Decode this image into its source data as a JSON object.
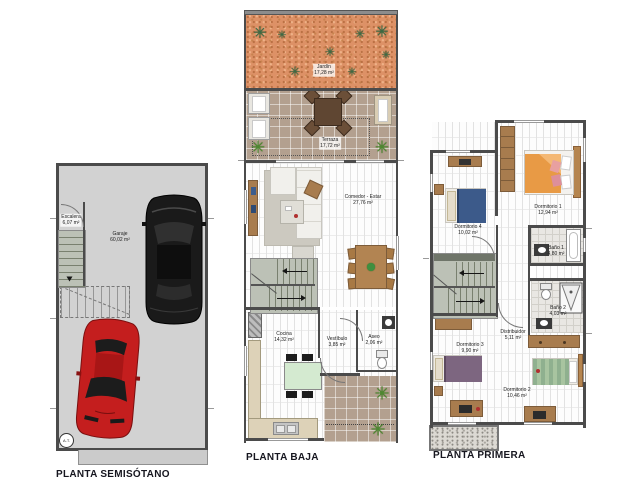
{
  "plans": {
    "semisotano": {
      "title": "PLANTA SEMISÓTANO",
      "at_label": "A.T.",
      "rooms": {
        "escalera": {
          "name": "Escalera",
          "area": "6,07 m²"
        },
        "garaje": {
          "name": "Garaje",
          "area": "60,02 m²"
        }
      }
    },
    "baja": {
      "title": "PLANTA BAJA",
      "rooms": {
        "jardin": {
          "name": "Jardín",
          "area": "17,28 m²"
        },
        "terraza": {
          "name": "Terraza",
          "area": "17,72 m²"
        },
        "comedor": {
          "name": "Comedor - Estar",
          "area": "27,76 m²"
        },
        "cocina": {
          "name": "Cocina",
          "area": "14,32 m²"
        },
        "vestibulo": {
          "name": "Vestíbulo",
          "area": "3,85 m²"
        },
        "aseo": {
          "name": "Aseo",
          "area": "2,06 m²"
        }
      }
    },
    "primera": {
      "title": "PLANTA PRIMERA",
      "rooms": {
        "dormitorio1": {
          "name": "Dormitorio 1",
          "area": "12,94 m²"
        },
        "dormitorio4": {
          "name": "Dormitorio 4",
          "area": "10,02 m²"
        },
        "bano1": {
          "name": "Baño 1",
          "area": "4,80 m²"
        },
        "distribuidor": {
          "name": "Distribuidor",
          "area": "5,11 m²"
        },
        "bano2": {
          "name": "Baño 2",
          "area": "4,03 m²"
        },
        "dormitorio3": {
          "name": "Dormitorio 3",
          "area": "9,90 m²"
        },
        "dormitorio2": {
          "name": "Dormitorio 2",
          "area": "10,46 m²"
        }
      }
    }
  },
  "icons": {
    "plant_glyph": "✳"
  },
  "colors": {
    "wall": "#4b4b4b",
    "garage_floor": "#d2d2d2",
    "jardin": "#dd9166",
    "terraza_tile": "#b3a08f",
    "stair": "#bcc1b6",
    "wood": "#a87c4e",
    "sofa": "#f1f0ec",
    "car_red": "#c41e1e",
    "car_black": "#1a1a1a",
    "bed_blue": "#3c5a8a",
    "bed_orange": "#e89a45",
    "bed_purple": "#7d6680",
    "bed_green": "#8fb08f",
    "plant_green": "#3c6b44"
  }
}
